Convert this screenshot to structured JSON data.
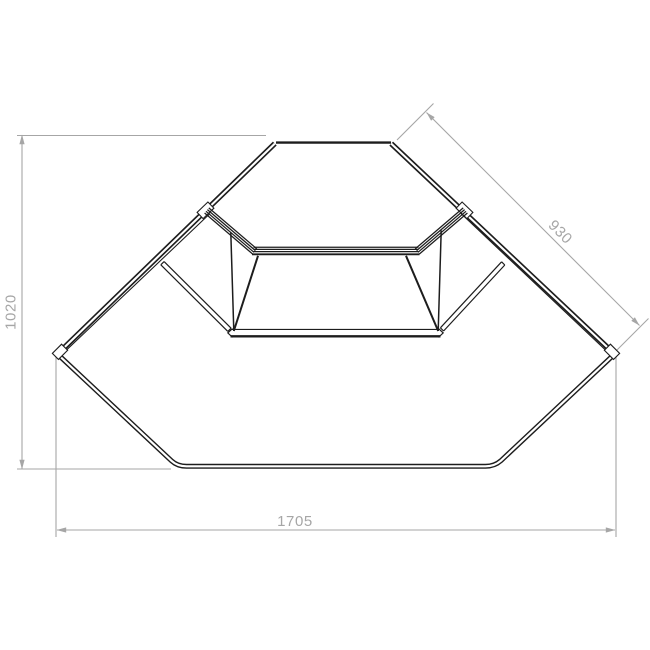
{
  "drawing": {
    "colors": {
      "background": "#ffffff",
      "outline": "#1d1d1d",
      "dimension": "#a6a6a6"
    },
    "dimensions": {
      "left": {
        "label": "1020",
        "orientation": "vertical"
      },
      "right_side": {
        "label": "930",
        "orientation": "diagonal"
      },
      "bottom": {
        "label": "1705",
        "orientation": "horizontal"
      }
    }
  }
}
